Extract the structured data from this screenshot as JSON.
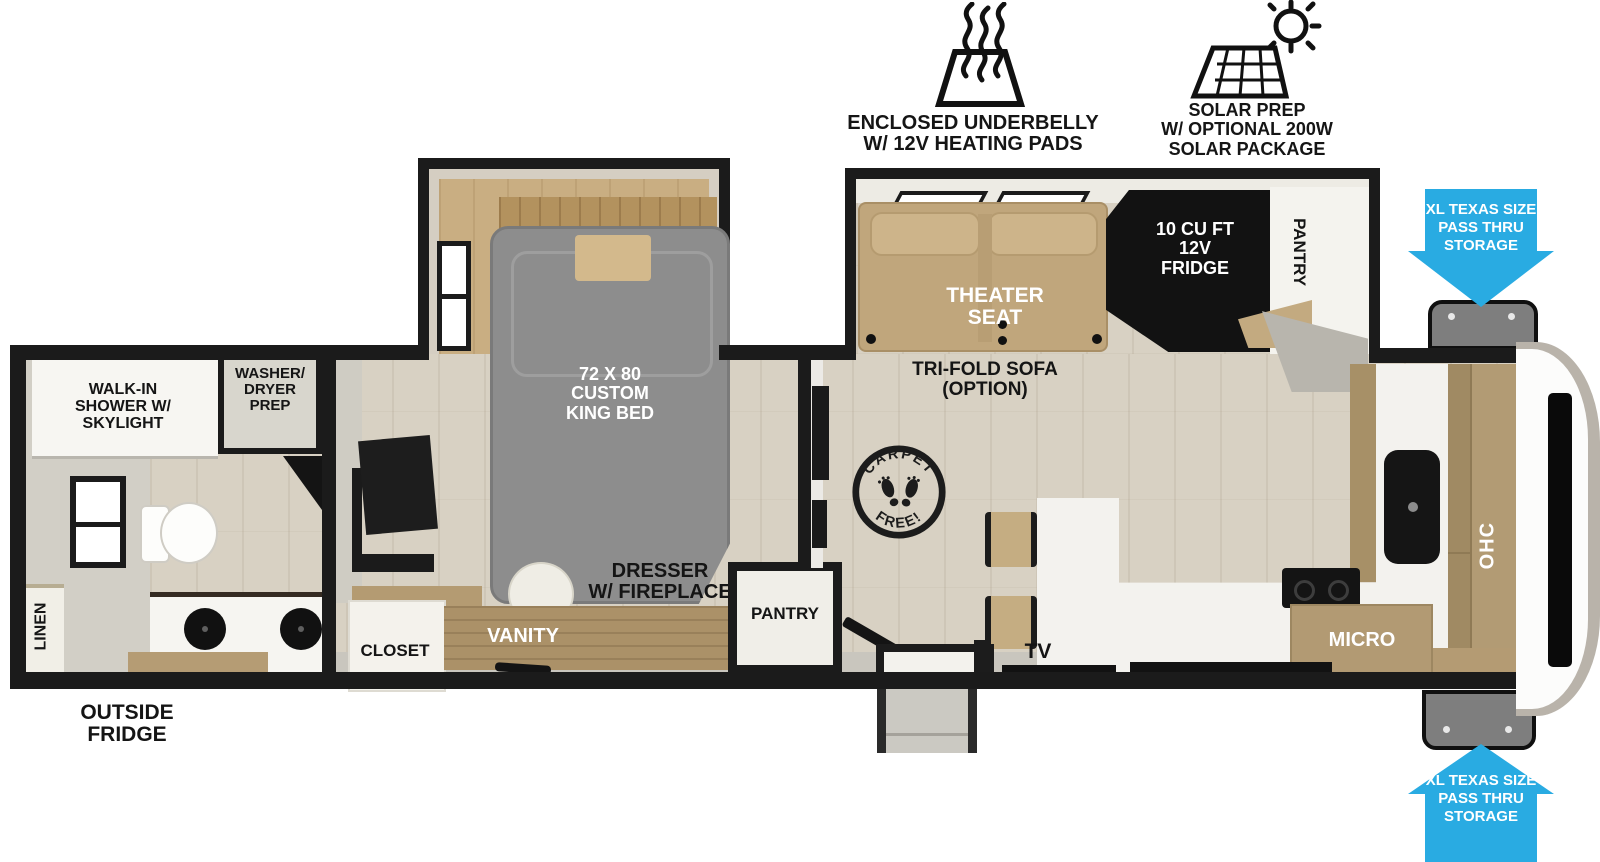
{
  "accent_blue": "#29ABE2",
  "wall_black": "#1b1b1b",
  "icons": {
    "underbelly": {
      "icon": "heating-pads-icon",
      "lines": [
        "ENCLOSED UNDERBELLY",
        "W/ 12V HEATING PADS"
      ]
    },
    "solar": {
      "icon": "solar-prep-icon",
      "lines": [
        "SOLAR PREP",
        "W/ OPTIONAL 200W",
        "SOLAR PACKAGE"
      ]
    }
  },
  "storage_callouts": {
    "top": {
      "lines": [
        "XL TEXAS SIZE",
        "PASS THRU",
        "STORAGE"
      ]
    },
    "bottom": {
      "lines": [
        "XL TEXAS SIZE",
        "PASS THRU",
        "STORAGE"
      ]
    }
  },
  "bathroom": {
    "shower": [
      "WALK-IN",
      "SHOWER W/",
      "SKYLIGHT"
    ],
    "washer_dryer": [
      "WASHER/",
      "DRYER",
      "PREP"
    ],
    "linen": "LINEN",
    "outside_fridge": [
      "OUTSIDE",
      "FRIDGE"
    ]
  },
  "bedroom": {
    "bed": [
      "72 X 80",
      "CUSTOM",
      "KING BED"
    ],
    "closet": "CLOSET",
    "vanity": "VANITY",
    "dresser": [
      "DRESSER",
      "W/ FIREPLACE"
    ],
    "pantry": "PANTRY"
  },
  "living": {
    "theater": [
      "THEATER",
      "SEAT"
    ],
    "sofa": [
      "TRI-FOLD SOFA",
      "(OPTION)"
    ],
    "fridge": [
      "10 CU FT",
      "12V",
      "FRIDGE"
    ],
    "pantry": "PANTRY",
    "tv": "TV",
    "stamp": {
      "top": "CARPET",
      "bottom": "FREE!"
    }
  },
  "kitchen": {
    "micro": "MICRO",
    "ohc": "OHC"
  }
}
